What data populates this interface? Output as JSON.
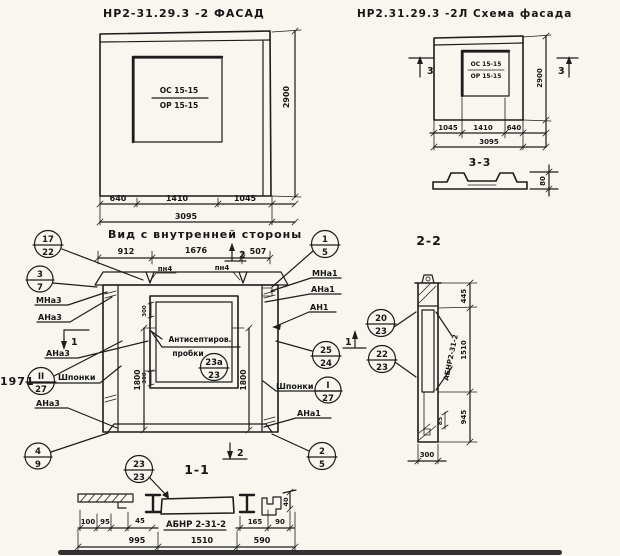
{
  "sheet": {
    "year_note": "1971",
    "paper": "#f8f6ef",
    "ink": "#1c1c1c"
  },
  "facade": {
    "title": "НР2-31.29.3 -2 ФАСАД",
    "window_top": "ОС 15-15",
    "window_bottom": "ОР 15-15",
    "dim_height": "2900",
    "dims": [
      "640",
      "1410",
      "1045"
    ],
    "dim_total": "3095"
  },
  "scheme": {
    "title": "НР2.31.29.3 -2Л Схема фасада",
    "window_top": "ОС 15-15",
    "window_bottom": "ОР 15-15",
    "dim_height": "2900",
    "dims": [
      "1045",
      "1410",
      "640"
    ],
    "dim_total": "3095",
    "cut_mark": "3",
    "section_label": "3-3",
    "profile_thickness": "80"
  },
  "inner": {
    "title": "Вид с внутренней стороны",
    "dims_top": [
      "912",
      "1676",
      "507"
    ],
    "cut_mark_1": "1",
    "cut_mark_2": "2",
    "joint_label": "пн4",
    "note_line1": "Антисептиров.",
    "note_line2": "пробки",
    "dim_1800": "1800",
    "dim_300": "300",
    "labels_left": {
      "mna3": "МНа3",
      "ana3_1": "АНа3",
      "ana3_2": "АНа3",
      "shponki": "Шпонки",
      "ana3_3": "АНа3"
    },
    "labels_right": {
      "mna1": "МНа1",
      "ana1_1": "АНа1",
      "an1": "АН1",
      "shponki": "Шпонки",
      "ana1_2": "АНа1"
    },
    "callouts_left": [
      {
        "top": "17",
        "bottom": "22"
      },
      {
        "top": "3",
        "bottom": "7"
      },
      {
        "top": "II",
        "bottom": "27"
      },
      {
        "top": "4",
        "bottom": "9"
      }
    ],
    "callouts_right": [
      {
        "top": "1",
        "bottom": "5"
      },
      {
        "top": "25",
        "bottom": "24"
      },
      {
        "top": "I",
        "bottom": "27"
      },
      {
        "top": "2",
        "bottom": "5"
      }
    ],
    "callout_window": {
      "top": "23а",
      "bottom": "23"
    }
  },
  "section11": {
    "label": "1-1",
    "callout": {
      "top": "23",
      "bottom": "23"
    },
    "mark": "АБНР 2-31-2",
    "dim_100": "100",
    "dim_95": "95",
    "dim_45": "45",
    "dim_165": "165",
    "dim_90": "90",
    "dim_40": "40",
    "dims_bottom": [
      "995",
      "1510",
      "590"
    ]
  },
  "section22": {
    "label": "2-2",
    "callouts": [
      {
        "top": "20",
        "bottom": "23"
      },
      {
        "top": "22",
        "bottom": "23"
      }
    ],
    "mark": "АБНР2-31-2",
    "dims_right": [
      "445",
      "1510",
      "945"
    ],
    "dim_85": "85",
    "dim_300": "300"
  }
}
